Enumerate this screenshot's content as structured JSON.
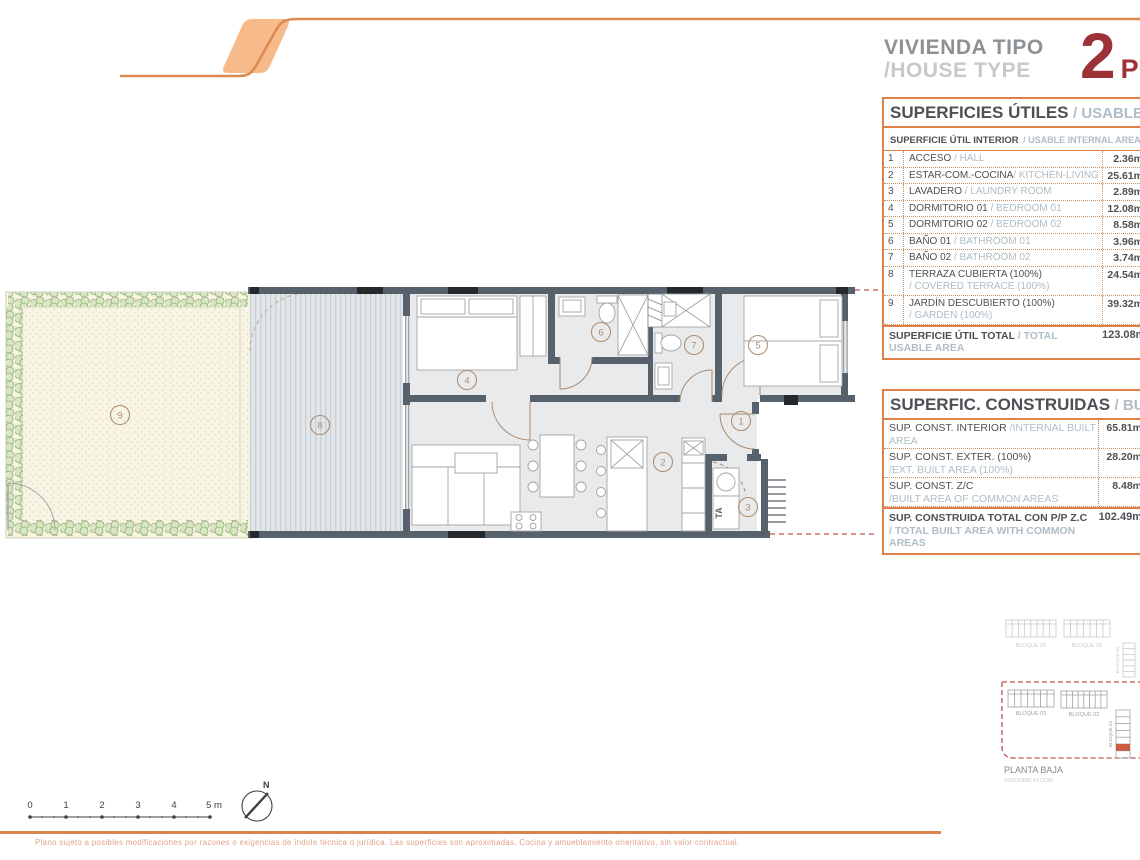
{
  "header": {
    "title_es": "VIVIENDA TIPO",
    "title_en": "/HOUSE TYPE",
    "unit_number": "2",
    "unit_suffix": "PE"
  },
  "usable_table": {
    "title_es": "SUPERFICIES ÚTILES",
    "title_en": "/ USABLE AREA",
    "subtitle_es": "SUPERFICIE ÚTIL INTERIOR",
    "subtitle_en": "/ USABLE INTERNAL AREA",
    "rows": [
      {
        "num": "1",
        "es": "ACCESO",
        "en": "/ HALL",
        "value": "2.36m"
      },
      {
        "num": "2",
        "es": "ESTAR-COM.-COCINA",
        "en": "/ KITCHEN-LIVING",
        "value": "25.61m"
      },
      {
        "num": "3",
        "es": "LAVADERO",
        "en": "/ LAUNDRY ROOM",
        "value": "2.89m"
      },
      {
        "num": "4",
        "es": "DORMITORIO 01",
        "en": "/ BEDROOM 01",
        "value": "12.08m"
      },
      {
        "num": "5",
        "es": "DORMITORIO 02",
        "en": "/ BEDROOM 02",
        "value": "8.58m"
      },
      {
        "num": "6",
        "es": "BAÑO 01",
        "en": "/ BATHROOM 01",
        "value": "3.96m"
      },
      {
        "num": "7",
        "es": "BAÑO 02",
        "en": "/ BATHROOM 02",
        "value": "3.74m"
      },
      {
        "num": "8",
        "es": "TERRAZA CUBIERTA (100%)",
        "en": "/ COVERED TERRACE (100%)",
        "value": "24.54m"
      },
      {
        "num": "9",
        "es": "JARDÍN DESCUBIERTO (100%)",
        "en": "/ GARDEN (100%)",
        "value": "39.32m"
      }
    ],
    "total_label_es": "SUPERFICIE ÚTIL TOTAL",
    "total_label_en": "/ TOTAL USABLE AREA",
    "total_value": "123.08m"
  },
  "built_table": {
    "title_es": "SUPERFIC. CONSTRUIDAS",
    "title_en": "/ BUILT AREA",
    "rows": [
      {
        "es": "SUP. CONST. INTERIOR",
        "en": "/INTERNAL BUILT AREA",
        "value": "65.81m"
      },
      {
        "es": "SUP. CONST. EXTER. (100%)",
        "en": "/EXT. BUILT AREA (100%)",
        "value": "28.20m"
      },
      {
        "es": "SUP. CONST. Z/C",
        "en": "/BUILT AREA OF COMMON AREAS",
        "value": "8.48m"
      }
    ],
    "total_label_es": "SUP. CONSTRUIDA TOTAL CON P/P Z.C",
    "total_label_en": "/ TOTAL BUILT AREA WITH COMMON AREAS",
    "total_value": "102.49m"
  },
  "plan": {
    "circles": [
      "1",
      "2",
      "3",
      "4",
      "5",
      "6",
      "7",
      "8",
      "9"
    ],
    "ta": "TA"
  },
  "scale_bar": {
    "labels": [
      "0",
      "1",
      "2",
      "3",
      "4",
      "5 m"
    ]
  },
  "compass": {
    "north": "N"
  },
  "site_plan": {
    "blocks": [
      "BLOQUE 05",
      "BLOQUE 06",
      "BLOQUE 04",
      "BLOQUE 03",
      "BLOQUE 02",
      "BLOQUE 01"
    ],
    "caption_es": "PLANTA BAJA",
    "caption_en": "/GROUND FLOOR"
  },
  "footer": {
    "disclaimer": "Plano sujeto a posibles modificaciones por razones o exigencias de índole técnica o jurídica. Las superficies son aproximadas. Cocina y amueblamiento orientativo, sin valor contractual."
  }
}
